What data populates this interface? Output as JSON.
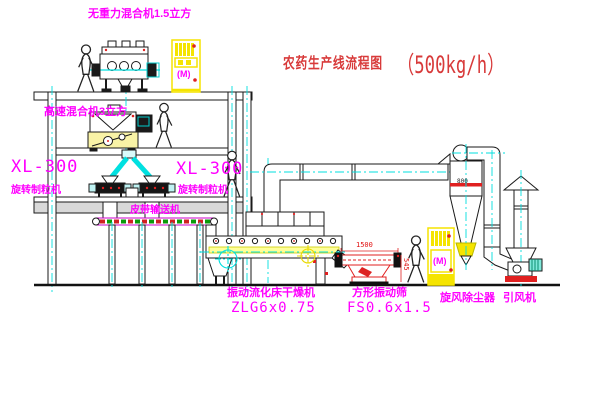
{
  "title": {
    "text": "农药生产线流程图",
    "capacity": "（500kg/h）"
  },
  "labels": {
    "gravity_mixer": "无重力混合机1.5立方",
    "high_speed_mixer": "高速混合机3立方",
    "granulator_model_left": "XL-300",
    "granulator_name_left": "旋转制粒机",
    "granulator_model_right": "XL-300",
    "granulator_name_right": "旋转制粒机",
    "belt_conveyor": "皮带输送机",
    "dryer_name": "振动流化床干燥机",
    "dryer_model": "ZLG6x0.75",
    "sieve_name": "方形振动筛",
    "sieve_model": "FS0.6x1.5",
    "cyclone": "旋风除尘器",
    "fan": "引风机"
  },
  "dimensions": {
    "sieve_length": "1500",
    "sieve_height": "545",
    "cyclone_diameter": "800"
  },
  "symbols": {
    "motor_top_cabinet": "(M)",
    "motor_right_cabinet": "(M)"
  },
  "colors": {
    "label_magenta": "#ff00ff",
    "title_red": "#d83a3a",
    "centerline_cyan": "#00dfdf",
    "machine_yellow": "#f5e400",
    "detail_red": "#e02020",
    "line_black": "#1a1a1a"
  }
}
